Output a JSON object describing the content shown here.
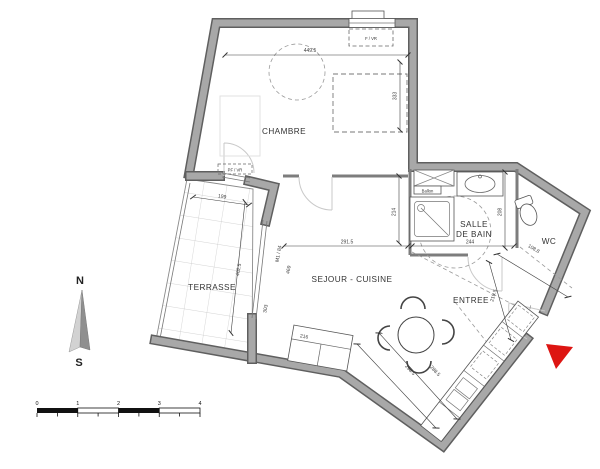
{
  "rooms": {
    "chambre": {
      "label": "CHAMBRE"
    },
    "terrasse": {
      "label": "TERRASSE"
    },
    "sejour": {
      "label": "SEJOUR - CUISINE"
    },
    "salle_de_bain": {
      "line1": "SALLE",
      "line2": "DE BAIN"
    },
    "wc": {
      "label": "WC"
    },
    "entree": {
      "label": "ENTREE"
    }
  },
  "dims": {
    "chambre_width": "449.5",
    "chambre_depth": "333",
    "terrasse_width": "199",
    "terrasse_depth": "402.5",
    "bay_total": "469",
    "bay_window": "M1 / 84",
    "terrace_door": "303",
    "sejour_depth": "214",
    "sejour_width": "291.5",
    "sdb_width": "244",
    "sdb_depth": "208",
    "wc_width": "108.8",
    "entree_depth": "219.5",
    "kitchen_run_1": "298.5",
    "kitchen_run_2": "288.5",
    "sofa_width": "216"
  },
  "labels": {
    "window_top": "F / VR",
    "window_terrace": "PF / VR",
    "water_heater": "Ballon"
  },
  "compass": {
    "north": "N",
    "south": "S"
  },
  "scalebar": {
    "ticks": [
      "0",
      "1",
      "2",
      "3",
      "4"
    ]
  },
  "colors": {
    "wall_fill": "#a8a8a8",
    "wall_edge": "#5f5f5f",
    "marker_red": "#dd1512"
  }
}
